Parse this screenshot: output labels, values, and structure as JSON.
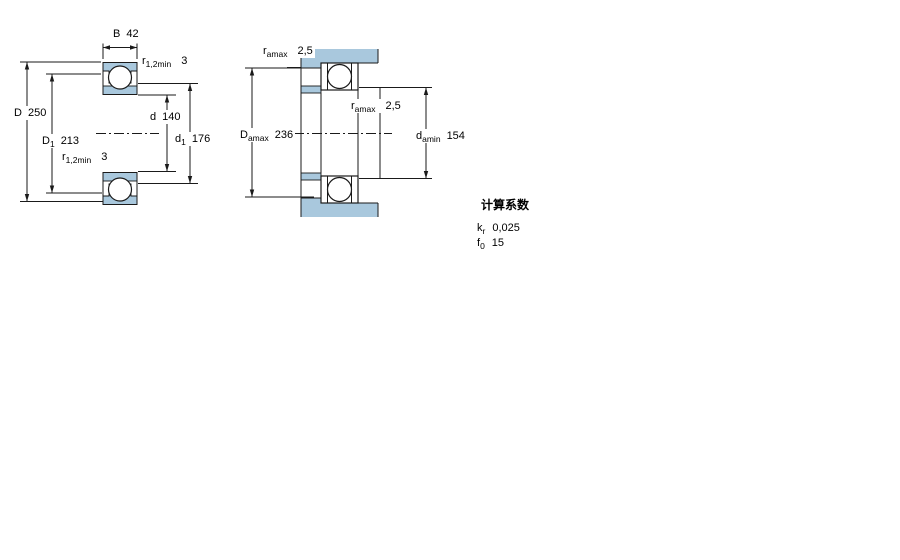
{
  "colors": {
    "section_fill": "#a9c8dd",
    "line": "#1a1a1a"
  },
  "left_diagram": {
    "B": {
      "main": "B",
      "value": "42"
    },
    "r_top": {
      "main": "r",
      "sub": "1,2min",
      "value": "3"
    },
    "D": {
      "main": "D",
      "value": "250"
    },
    "D1": {
      "main": "D",
      "sub": "1",
      "value": "213"
    },
    "r_bottom": {
      "main": "r",
      "sub": "1,2min",
      "value": "3"
    },
    "d": {
      "main": "d",
      "value": "140"
    },
    "d1": {
      "main": "d",
      "sub": "1",
      "value": "176"
    }
  },
  "right_diagram": {
    "ra_top": {
      "main": "r",
      "sub": "amax",
      "value": "2,5"
    },
    "Da": {
      "main": "D",
      "sub": "amax",
      "value": "236"
    },
    "ra_mid": {
      "main": "r",
      "sub": "amax",
      "value": "2,5"
    },
    "da": {
      "main": "d",
      "sub": "amin",
      "value": "154"
    }
  },
  "calculation_factors": {
    "title": "计算系数",
    "kr": {
      "main": "k",
      "sub": "r",
      "value": "0,025"
    },
    "f0": {
      "main": "f",
      "sub": "0",
      "value": "15"
    }
  }
}
